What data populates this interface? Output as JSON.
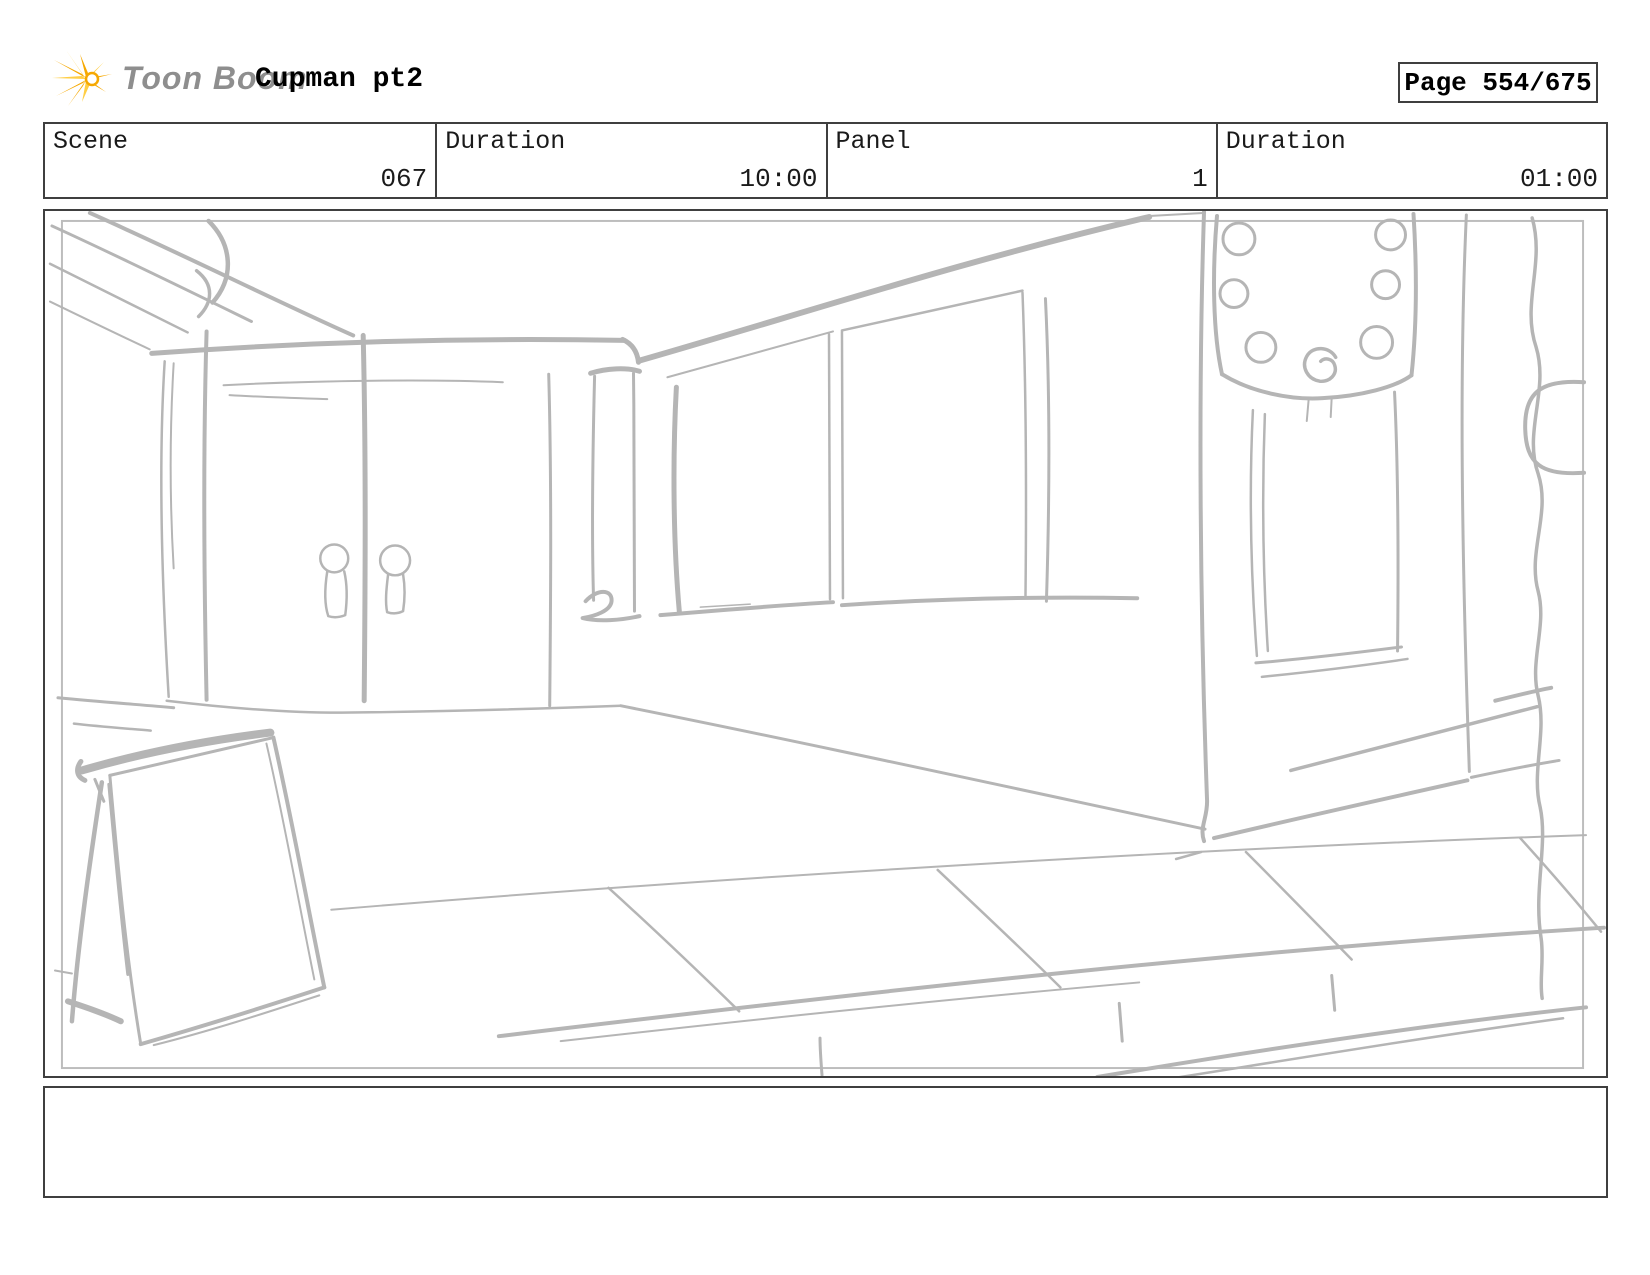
{
  "header": {
    "logo_text": "Toon Boom",
    "project_title": "Cupman pt2",
    "page_label": "Page 554/675"
  },
  "meta": {
    "cells": [
      {
        "label": "Scene",
        "value": "067"
      },
      {
        "label": "Duration",
        "value": "10:00"
      },
      {
        "label": "Panel",
        "value": "1"
      },
      {
        "label": "Duration",
        "value": "01:00"
      }
    ]
  },
  "notes": {
    "text": ""
  },
  "colors": {
    "sketch_stroke": "#b5b5b5",
    "frame_gray": "#bdbdbd",
    "border_dark": "#3f3f3f",
    "logo_gray": "#8e8e8e",
    "logo_gold": "#f6a800",
    "logo_gold_light": "#ffce45"
  }
}
